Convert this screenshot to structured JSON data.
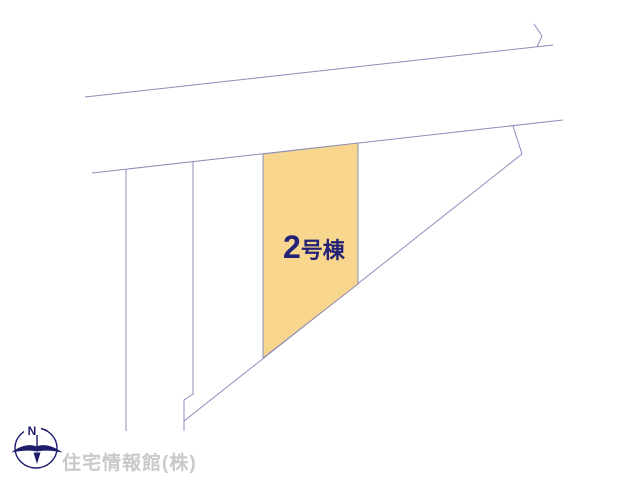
{
  "colors": {
    "background": "#ffffff",
    "boundary_line": "#8d8dbb",
    "parcel_fill": "#f8d68d",
    "parcel_label_text": "#232277",
    "compass": "#1d1d6b",
    "watermark_text": "#c9c9c9"
  },
  "plan": {
    "highlighted_parcel": {
      "number": "2",
      "suffix": "号棟",
      "full_label": "2号棟"
    }
  },
  "compass": {
    "north_label": "N"
  },
  "watermark": {
    "company": "住宅情報館(株)"
  }
}
